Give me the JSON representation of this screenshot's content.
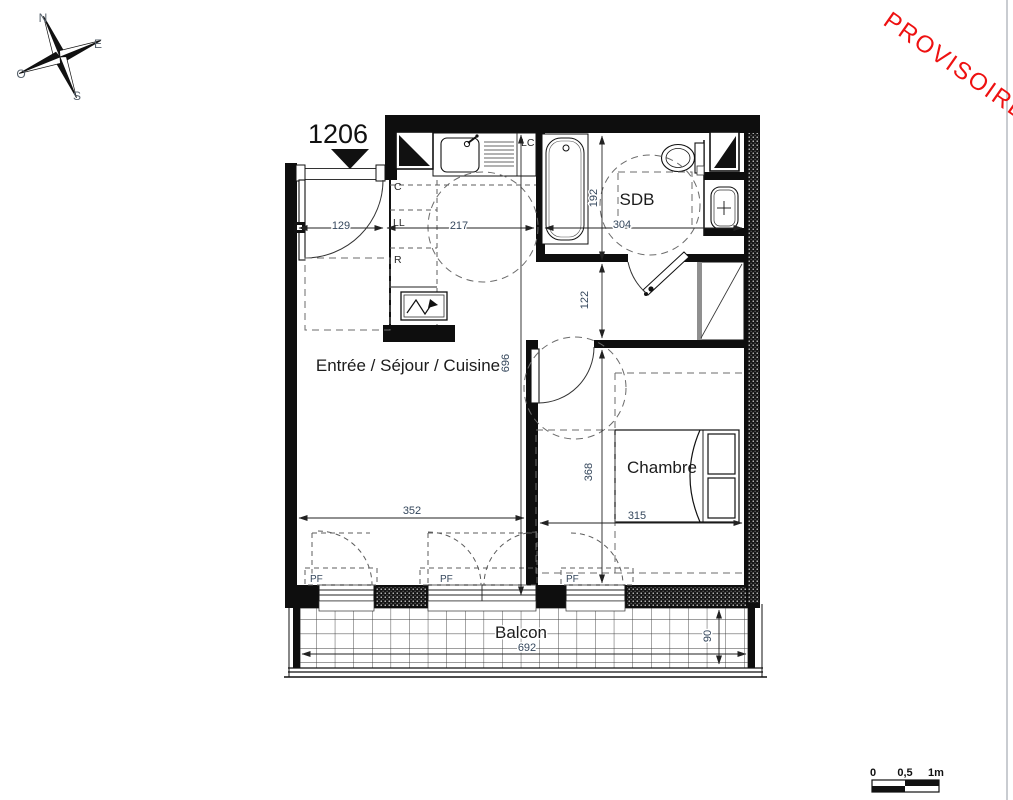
{
  "stamp": {
    "text": "PROVISOIRE",
    "color": "#ee1111"
  },
  "unit": {
    "number": "1206"
  },
  "compass": {
    "north": "N",
    "east": "E",
    "south": "S",
    "west": "O"
  },
  "rooms": {
    "living": "Entrée / Séjour / Cuisine",
    "bathroom": "SDB",
    "bedroom": "Chambre",
    "balcony": "Balcon"
  },
  "fixtures": {
    "closet": "C",
    "washing_machine": "LL",
    "fridge": "R",
    "kitchen_unit": "LC"
  },
  "window_label": "PF",
  "dimensions": {
    "entry_width": "129",
    "kitchen_width": "217",
    "bathroom_width": "304",
    "bathroom_depth": "192",
    "hallway_depth": "122",
    "living_depth": "696",
    "living_width": "352",
    "bedroom_depth": "368",
    "bedroom_width": "315",
    "balcony_width": "692",
    "balcony_depth": "90"
  },
  "scale_bar": {
    "zero": "0",
    "half": "0,5",
    "one": "1m"
  },
  "colors": {
    "dimension_text": "#35475c",
    "stamp": "#ee1111",
    "ink": "#111111"
  }
}
